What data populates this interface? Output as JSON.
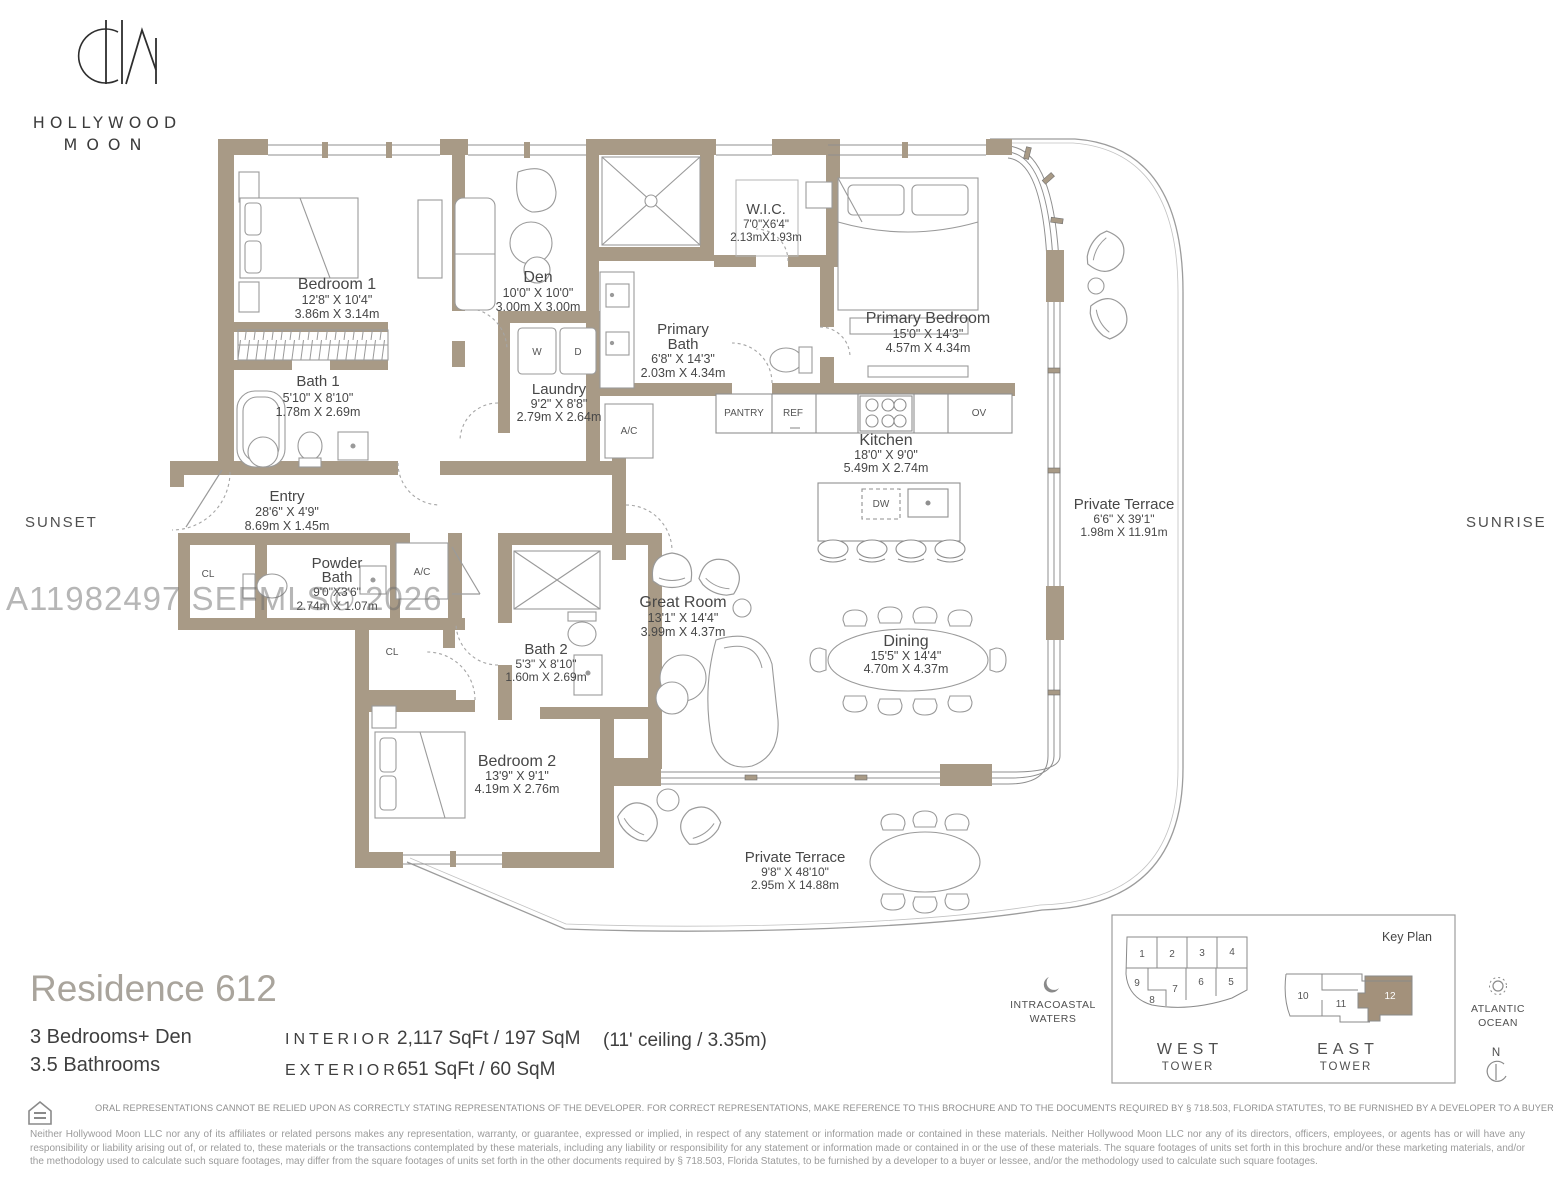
{
  "brand": {
    "monogram": "HM",
    "name_line1": "HOLLYWOOD",
    "name_line2": "MOON"
  },
  "orientation": {
    "west": "SUNSET",
    "east": "SUNRISE"
  },
  "watermark": "A11982497 SEFMLS© 2026",
  "rooms": {
    "bedroom1": {
      "name": "Bedroom 1",
      "ft": "12'8\" X 10'4\"",
      "m": "3.86m X 3.14m"
    },
    "den": {
      "name": "Den",
      "ft": "10'0\" X 10'0\"",
      "m": "3.00m X 3.00m"
    },
    "wic": {
      "name": "W.I.C.",
      "ft": "7'0\"X6'4\"",
      "m": "2.13mX1.93m"
    },
    "primary_bath": {
      "name1": "Primary",
      "name2": "Bath",
      "ft": "6'8\" X 14'3\"",
      "m": "2.03m X 4.34m"
    },
    "primary_bedroom": {
      "name": "Primary Bedroom",
      "ft": "15'0\" X 14'3\"",
      "m": "4.57m X 4.34m"
    },
    "bath1": {
      "name": "Bath 1",
      "ft": "5'10\" X 8'10\"",
      "m": "1.78m X 2.69m"
    },
    "laundry": {
      "name": "Laundry",
      "ft": "9'2\" X 8'8\"",
      "m": "2.79m X 2.64m"
    },
    "kitchen": {
      "name": "Kitchen",
      "ft": "18'0\" X 9'0\"",
      "m": "5.49m X 2.74m"
    },
    "entry": {
      "name": "Entry",
      "ft": "28'6\" X 4'9\"",
      "m": "8.69m X 1.45m"
    },
    "powder_bath": {
      "name1": "Powder",
      "name2": "Bath",
      "ft": "9'0\"X3'6\"",
      "m": "2.74m X 1.07m"
    },
    "great_room": {
      "name": "Great Room",
      "ft": "13'1\" X 14'4\"",
      "m": "3.99m X 4.37m"
    },
    "dining": {
      "name": "Dining",
      "ft": "15'5\" X 14'4\"",
      "m": "4.70m X 4.37m"
    },
    "bath2": {
      "name": "Bath 2",
      "ft": "5'3\" X 8'10\"",
      "m": "1.60m X 2.69m"
    },
    "bedroom2": {
      "name": "Bedroom 2",
      "ft": "13'9\" X 9'1\"",
      "m": "4.19m X 2.76m"
    },
    "terrace_east": {
      "name": "Private Terrace",
      "ft": "6'6\" X 39'1\"",
      "m": "1.98m X 11.91m"
    },
    "terrace_south": {
      "name": "Private Terrace",
      "ft": "9'8\" X 48'10\"",
      "m": "2.95m X 14.88m"
    }
  },
  "fixtures": {
    "washer": "W",
    "dryer": "D",
    "ac": "A/C",
    "closet": "CL",
    "pantry": "PANTRY",
    "fridge": "REF",
    "oven": "OV",
    "dishwasher": "DW"
  },
  "residence": {
    "title": "Residence 612",
    "line1": "3 Bedrooms+ Den",
    "line2": "3.5 Bathrooms",
    "interior_label": "INTERIOR",
    "interior_value": "2,117 SqFt / 197 SqM",
    "exterior_label": "EXTERIOR",
    "exterior_value": "651 SqFt / 60 SqM",
    "ceiling_note": "(11' ceiling / 3.35m)"
  },
  "key_plan": {
    "title": "Key Plan",
    "west_units": [
      "1",
      "2",
      "3",
      "4",
      "9",
      "7",
      "6",
      "5",
      "8"
    ],
    "east_units": [
      "10",
      "11",
      "12"
    ],
    "highlighted_unit": "12",
    "west_tower_line1": "WEST",
    "west_tower_line2": "TOWER",
    "east_tower_line1": "EAST",
    "east_tower_line2": "TOWER",
    "west_label_line1": "INTRACOASTAL",
    "west_label_line2": "WATERS",
    "east_label_line1": "ATLANTIC",
    "east_label_line2": "OCEAN",
    "north": "N",
    "highlight_color": "#a3917b"
  },
  "colors": {
    "wall": "#a89a86",
    "accent": "#a3917b"
  },
  "disclaimer": {
    "headline": "ORAL REPRESENTATIONS CANNOT BE RELIED UPON AS CORRECTLY STATING REPRESENTATIONS OF THE DEVELOPER. FOR CORRECT REPRESENTATIONS, MAKE REFERENCE TO THIS BROCHURE AND TO THE DOCUMENTS REQUIRED BY § 718.503, FLORIDA STATUTES, TO BE FURNISHED BY A DEVELOPER TO A BUYER OR LESSEE",
    "body": "Neither Hollywood Moon LLC nor any of its affiliates or related persons makes any representation, warranty, or guarantee, expressed or implied, in respect of any statement or information made or contained in these materials. Neither Hollywood Moon LLC nor any of its directors, officers, employees, or agents has or will have any responsibility or liability arising out of, or related to, these materials or the transactions contemplated by these materials, including any liability or responsibility for any statement or information made or contained in or the use of these materials. The square footages of units set forth in this brochure and/or these marketing materials, and/or the methodology used to calculate such square footages, may differ from the square footages of units set forth in the other documents required by § 718.503, Florida Statutes, to be furnished by a developer to a buyer or lessee, and/or the methodology used to calculate such square footages."
  }
}
